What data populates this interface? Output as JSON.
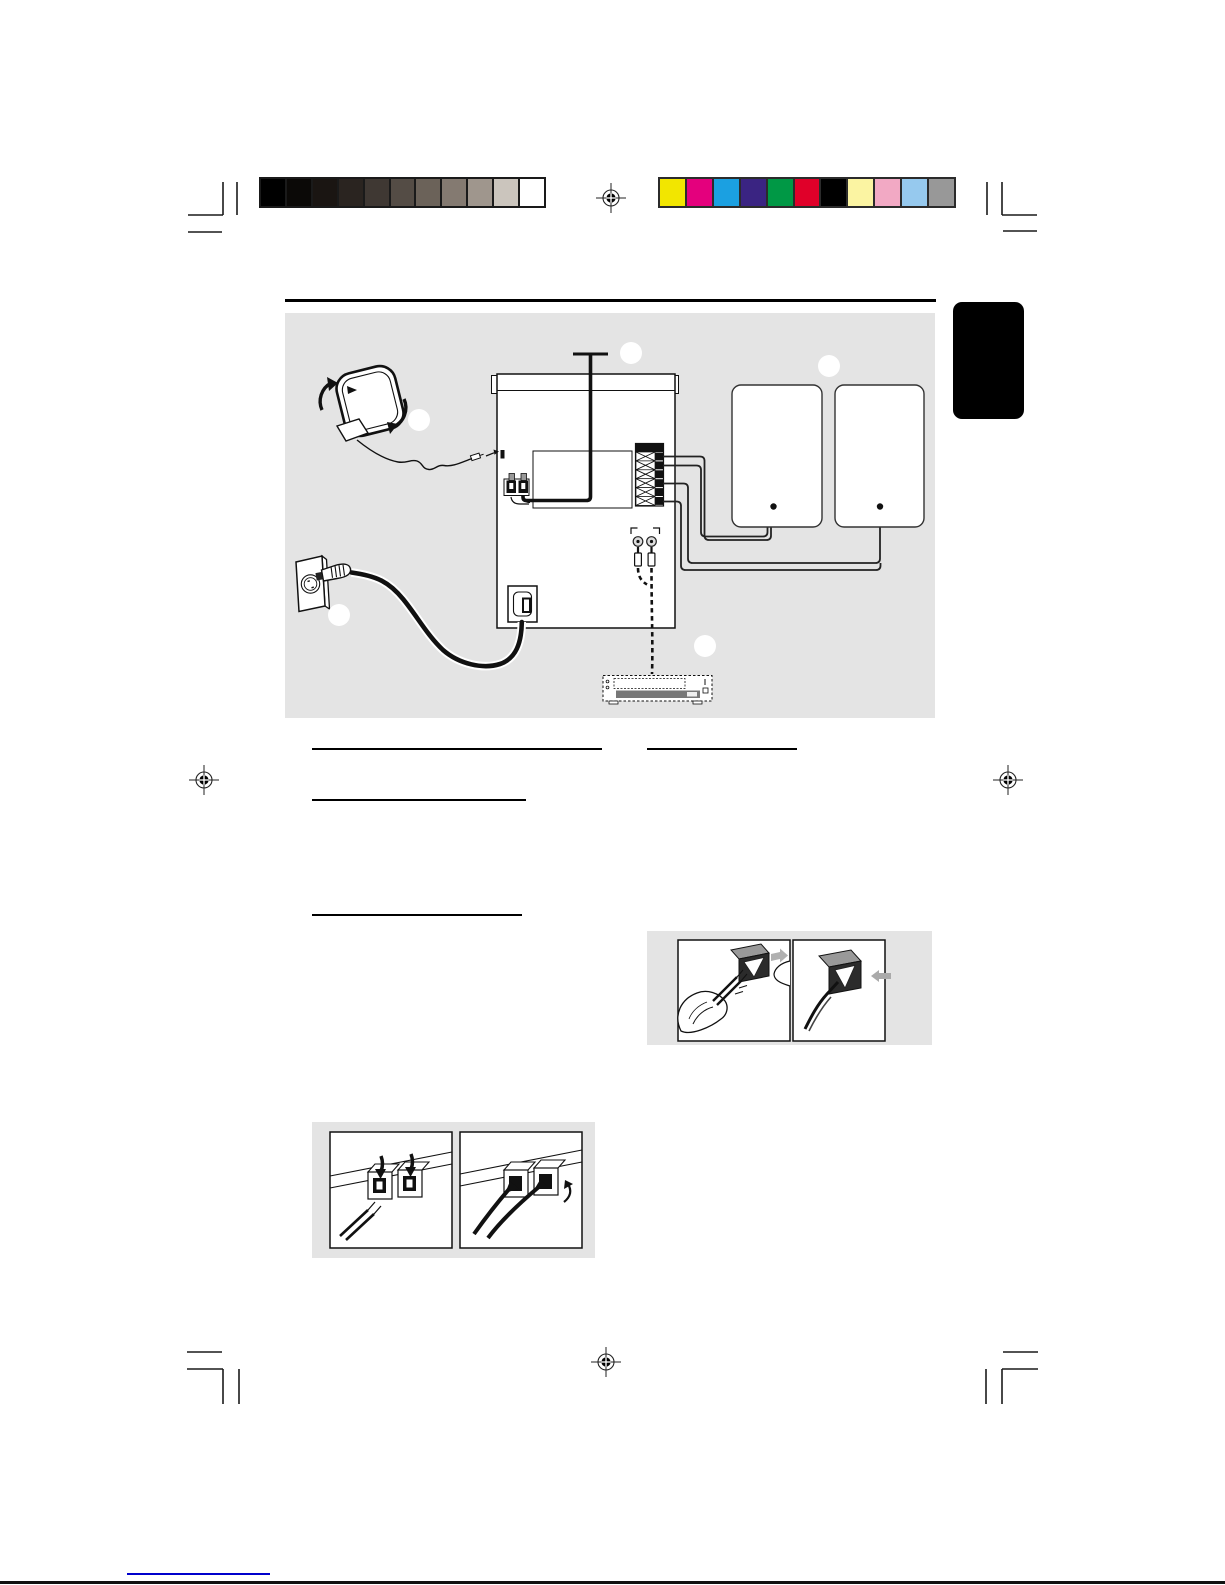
{
  "page": {
    "background": "#ffffff",
    "bottom_edge_color": "#111111",
    "note": "manual page proof – body text layer not rendered, only rules and artwork visible"
  },
  "calibration": {
    "grayscale_bar": {
      "frame": "#1a1a1a",
      "swatches": [
        "#000000",
        "#0b0907",
        "#1a1512",
        "#2a2420",
        "#3f3833",
        "#544c45",
        "#6b6259",
        "#847a71",
        "#9f968d",
        "#cbc5bd",
        "#ffffff"
      ]
    },
    "color_bar": {
      "frame": "#2b2b2b",
      "swatches": [
        "#f2e600",
        "#e4007d",
        "#1ba0e1",
        "#3a2482",
        "#009845",
        "#e00029",
        "#000000",
        "#fbf4a2",
        "#f2a9c4",
        "#96c9ee",
        "#989898"
      ]
    }
  },
  "registration_mark": {
    "color": "#1a1a1a",
    "count": 4
  },
  "crop_marks": {
    "color": "#1a1a1a",
    "corners": 4
  },
  "section_tab": {
    "fill": "#000000"
  },
  "heading_rule": {
    "color": "#000000"
  },
  "content_rules": {
    "color": "#000000",
    "count": 4
  },
  "diagram": {
    "background": "#e4e4e4",
    "callout_fill": "#ffffff",
    "callout_count": 5,
    "elements": [
      "am-loop-antenna",
      "fm-wire-antenna",
      "main-unit-rear",
      "speaker-terminal-block",
      "left-speaker",
      "right-speaker",
      "wall-outlet",
      "power-cord",
      "ac-inlet",
      "rca-jacks",
      "dashed-aux-cable",
      "external-device"
    ]
  },
  "detail_boxes": {
    "background": "#e4e4e4",
    "speaker_wire_detail": {
      "panels": 2
    },
    "power_terminal_detail": {
      "panels": 2
    }
  },
  "footer": {
    "link_underline_color": "#0000cc"
  }
}
